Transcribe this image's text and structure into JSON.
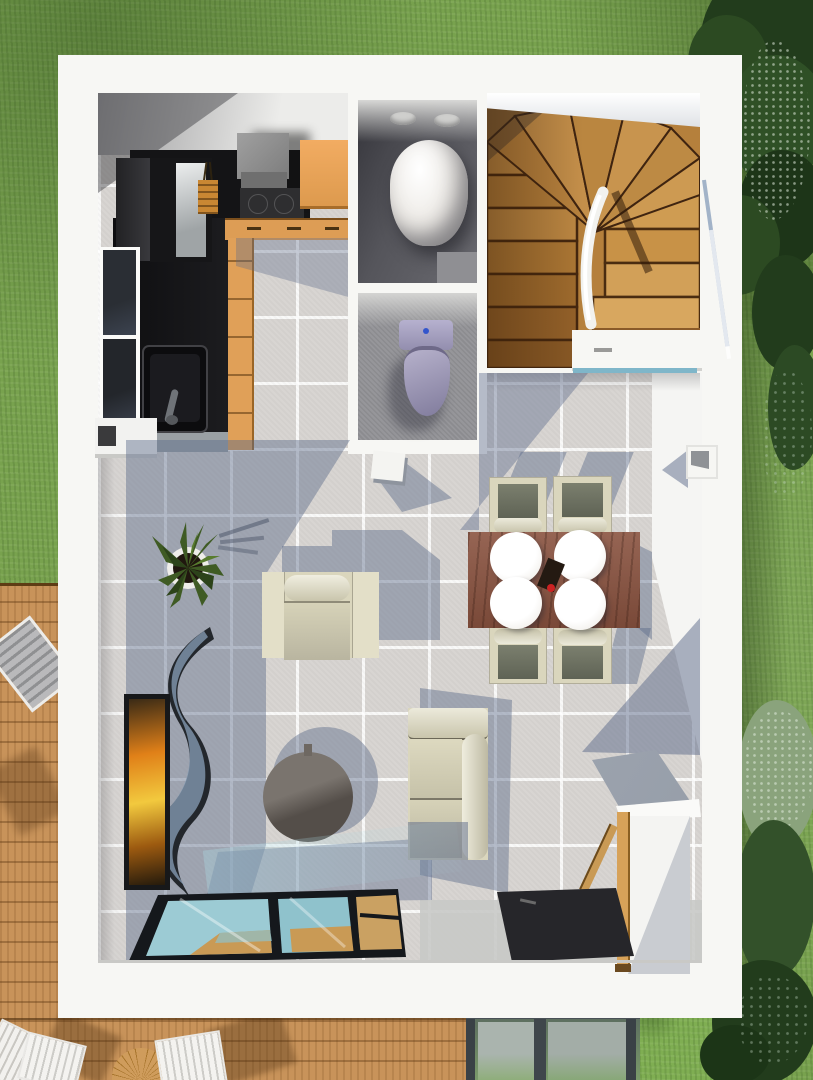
{
  "scene": {
    "type": "3d-floorplan-render",
    "view": "top-down",
    "inventory": [
      "grass lawn",
      "ornamental trees",
      "wooden deck with outdoor chairs and round table",
      "glass garden fence",
      "house shell with white walls",
      "kitchen with black L-counter, orange cabinets, extractor hood, sink, window",
      "shower room with water cylinder and vents",
      "wc with toilet",
      "winder wooden staircase with white railing",
      "under-stairs cupboard",
      "dining table with four plates and four chairs",
      "armchair",
      "two-seat sofa",
      "round coffee table",
      "potted plant",
      "wavy room divider",
      "orange wall art",
      "console table",
      "dark doormat",
      "glass floor panel",
      "wall niche"
    ]
  },
  "colors": {
    "grass": "#78a24e",
    "grassBright": "#7fae52",
    "treeDark": "#223c1c",
    "treeMid": "#2c4a22",
    "treeLight": "#8aa37c",
    "deck": "#c8935a",
    "houseWhite": "#f7f7f4",
    "tile": "#d8d5d2",
    "shadowBlue": "rgba(91,106,138,0.45)",
    "counterBlack": "#141416",
    "cabinetOrange": "#e0a058",
    "hoodGray": "#8f8f8f",
    "stairWood": "#c08a47",
    "stairWoodLit": "#d8a75f",
    "stairWoodDark": "#8a5a28",
    "bathFloorDark": "#4b4b4f",
    "wcFloor": "#96969a",
    "toiletLavender": "#a8a3c2",
    "cream": "#dad6bd",
    "tableBrown": "#8a5340",
    "coffeeTable": "#6e6862",
    "glassCyan": "#9ccbd4",
    "glassWood": "#c99a55",
    "mat": "#26262a",
    "artOrange": "#e08018",
    "artYellow": "#f2c93e",
    "consoleTan": "#d7a259",
    "railBlue": "#93a7c0",
    "plantGreen": "#3f5b24"
  }
}
